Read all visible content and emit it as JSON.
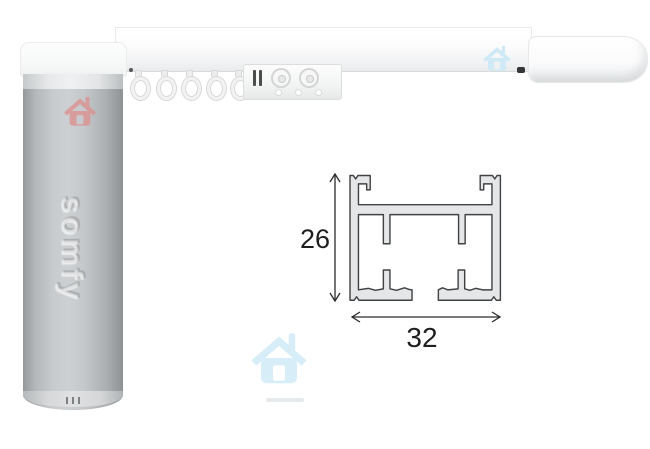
{
  "product_photo": {
    "brand_logo": "somfy",
    "description_labels": {
      "height_dimension": "26",
      "width_dimension": "32"
    }
  },
  "diagram": {
    "height_mm": "26",
    "width_mm": "32"
  },
  "icons": {
    "vent_marks": "|||",
    "house_watermark_red": "house-icon",
    "house_watermark_blue_small": "house-icon",
    "house_watermark_blue_large": "house-icon",
    "height_dimension_arrow": "double-arrow-vertical-icon",
    "width_dimension_arrow": "double-arrow-horizontal-icon"
  },
  "colors": {
    "background": "#ffffff",
    "motor_body_edge": "#95989b",
    "motor_body_mid": "#cdd0d2",
    "motor_cap": "#fafbfb",
    "rail_white": "#f7f8f9",
    "profile_fill": "#e4e6e8",
    "profile_stroke": "#414243",
    "dimension_text": "#1e1e1e",
    "watermark_red": "#dc9191",
    "watermark_blue": "#cfe9f6",
    "watermark_blue_large": "#d7eef9"
  }
}
